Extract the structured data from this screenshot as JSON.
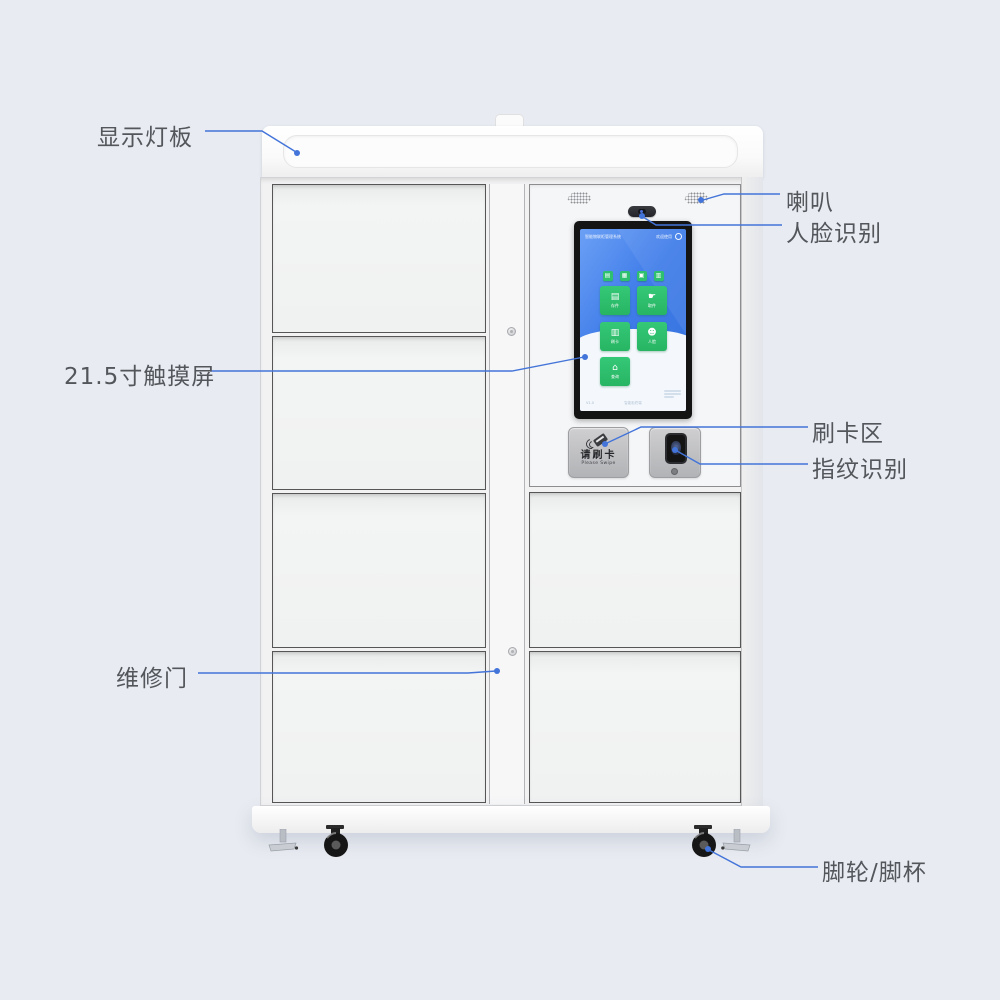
{
  "page": {
    "background": "#e8ebf1"
  },
  "annotations": {
    "line_color": "#4374d9",
    "labels": [
      {
        "id": "display-light-panel",
        "text": "显示灯板"
      },
      {
        "id": "speaker",
        "text": "喇叭"
      },
      {
        "id": "face-recognition",
        "text": "人脸识别"
      },
      {
        "id": "touchscreen",
        "text": "21.5寸触摸屏"
      },
      {
        "id": "card-swipe-area",
        "text": "刷卡区"
      },
      {
        "id": "fingerprint-reader",
        "text": "指纹识别"
      },
      {
        "id": "maintenance-door",
        "text": "维修门"
      },
      {
        "id": "caster-foot",
        "text": "脚轮/脚杯"
      }
    ]
  },
  "kiosk_screen": {
    "colors": {
      "blue": "#3f7ce8",
      "green": "#2ec06e"
    },
    "topbar": {
      "title": "智能物联柜管理系统",
      "status": "欢迎使用"
    },
    "quick_icons": [
      {
        "name": "mini-icon-1",
        "glyph": "▤"
      },
      {
        "name": "mini-icon-2",
        "glyph": "▦"
      },
      {
        "name": "mini-icon-3",
        "glyph": "▣"
      },
      {
        "name": "mini-icon-4",
        "glyph": "▥"
      }
    ],
    "buttons": [
      {
        "name": "deposit",
        "glyph": "▤",
        "label": "存件"
      },
      {
        "name": "pickup",
        "glyph": "☛",
        "label": "取件"
      },
      {
        "name": "swipe-card",
        "glyph": "▥",
        "label": "刷卡"
      },
      {
        "name": "face",
        "glyph": "☻",
        "label": "人脸"
      },
      {
        "name": "query",
        "glyph": "⌂",
        "label": "查询"
      }
    ],
    "footer": {
      "left": "V1.0",
      "center": "智能柜终端"
    }
  },
  "card_reader": {
    "line1": "请刷卡",
    "line2": "Please Swipe"
  }
}
